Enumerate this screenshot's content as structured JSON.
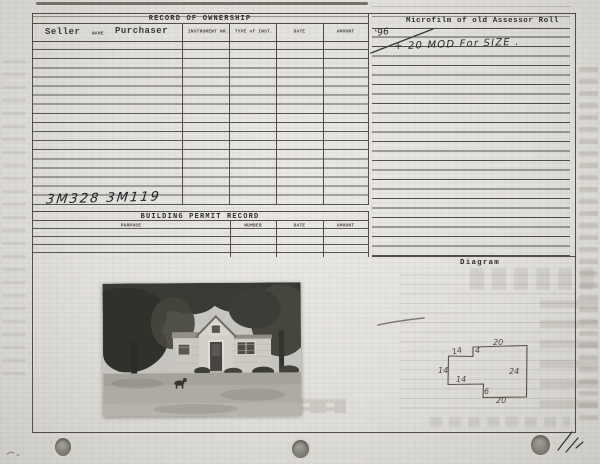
{
  "card": {
    "ownership": {
      "title": "RECORD OF OWNERSHIP",
      "seller_label": "Seller",
      "name_label": "NAME",
      "purchaser_label": "Purchaser",
      "columns": [
        "INSTRUMENT NR.",
        "TYPE of INST.",
        "DATE",
        "AMOUNT"
      ],
      "row_count": 18,
      "handwritten_entry": "3M328  3M119"
    },
    "microfilm": {
      "title": "Microfilm of old Assessor Roll",
      "handwritten_year": "'96",
      "handwritten_note": "+ 20 MOD For SIZE ."
    },
    "permits": {
      "title": "BUILDING PERMIT RECORD",
      "columns": [
        "PURPOSE",
        "NUMBER",
        "DATE",
        "AMOUNT"
      ],
      "row_count": 4
    },
    "diagram": {
      "title": "Diagram",
      "sketch": {
        "top": "20",
        "right": "24",
        "bottom": "20",
        "step_top": "4",
        "step_bottom": "6",
        "wing_top": "14",
        "wing_left": "14",
        "wing_bottom": "14"
      }
    },
    "photo": {
      "alt": "Black-and-white photograph of a small one-story house with a center gable entry, trees behind and lawn in front"
    }
  }
}
